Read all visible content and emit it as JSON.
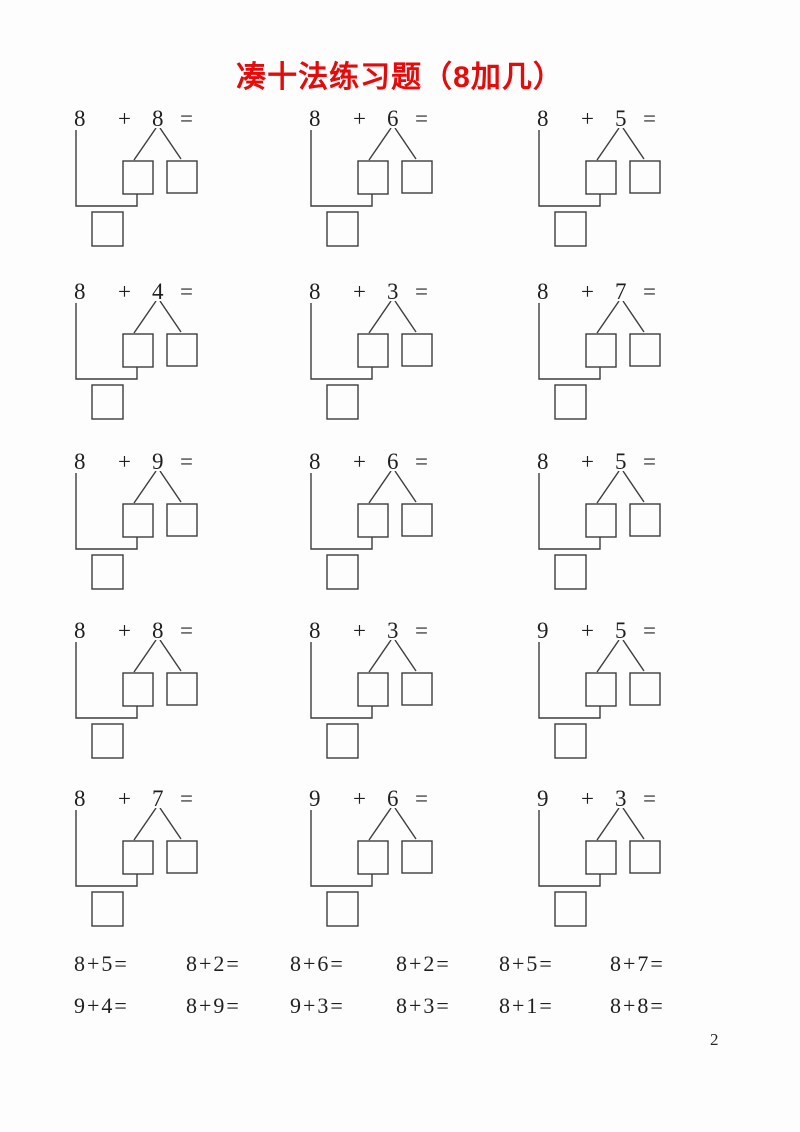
{
  "page": {
    "title": "凑十法练习题（8加几）",
    "title_color": "#e60b0b",
    "page_number": "2",
    "background": "#fdfdfd",
    "line_color": "#3d3d3d"
  },
  "problems": [
    {
      "a": "8",
      "op": "+",
      "b": "8",
      "eq": "="
    },
    {
      "a": "8",
      "op": "+",
      "b": "6",
      "eq": "="
    },
    {
      "a": "8",
      "op": "+",
      "b": "5",
      "eq": "="
    },
    {
      "a": "8",
      "op": "+",
      "b": "4",
      "eq": "="
    },
    {
      "a": "8",
      "op": "+",
      "b": "3",
      "eq": "="
    },
    {
      "a": "8",
      "op": "+",
      "b": "7",
      "eq": "="
    },
    {
      "a": "8",
      "op": "+",
      "b": "9",
      "eq": "="
    },
    {
      "a": "8",
      "op": "+",
      "b": "6",
      "eq": "="
    },
    {
      "a": "8",
      "op": "+",
      "b": "5",
      "eq": "="
    },
    {
      "a": "8",
      "op": "+",
      "b": "8",
      "eq": "="
    },
    {
      "a": "8",
      "op": "+",
      "b": "3",
      "eq": "="
    },
    {
      "a": "9",
      "op": "+",
      "b": "5",
      "eq": "="
    },
    {
      "a": "8",
      "op": "+",
      "b": "7",
      "eq": "="
    },
    {
      "a": "9",
      "op": "+",
      "b": "6",
      "eq": "="
    },
    {
      "a": "9",
      "op": "+",
      "b": "3",
      "eq": "="
    }
  ],
  "practice_rows": [
    {
      "items": [
        "8+5=",
        "8+2=",
        "8+6=",
        "8+2=",
        "8+5=",
        "8+7="
      ]
    },
    {
      "items": [
        "9+4=",
        "8+9=",
        "9+3=",
        "8+3=",
        "8+1=",
        "8+8="
      ]
    }
  ]
}
